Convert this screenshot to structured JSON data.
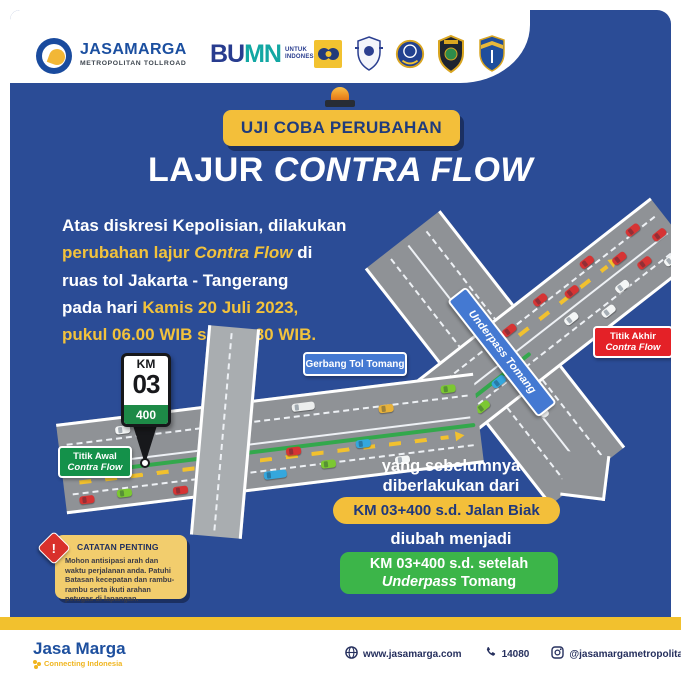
{
  "header": {
    "jasamarga_logo": {
      "title": "JASAMARGA",
      "subtitle": "METROPOLITAN TOLLROAD"
    },
    "bumn_logo": {
      "bu": "BU",
      "mn": "MN",
      "tagline_line1": "UNTUK",
      "tagline_line2": "INDONESIA"
    }
  },
  "banner": {
    "label": "UJI COBA PERUBAHAN"
  },
  "title": {
    "regular": "LAJUR ",
    "italic": "CONTRA FLOW"
  },
  "intro": {
    "line1": "Atas diskresi Kepolisian, dilakukan",
    "line2_highlight": "perubahan lajur ",
    "line2_italic": "Contra Flow",
    "line2_tail": " di",
    "line3": "ruas tol Jakarta - Tangerang",
    "line4_regular": "pada hari ",
    "line4_highlight": "Kamis 20 Juli 2023,",
    "line5_highlight": "pukul 06.00 WIB s.d. 08.30 WIB."
  },
  "map": {
    "km_sign": {
      "label": "KM",
      "number": "03",
      "meters": "400"
    },
    "start_badge": {
      "line1": "Titik Awal",
      "line2": "Contra Flow"
    },
    "toll_gate_badge": "Gerbang Tol Tomang",
    "underpass_badge": "Underpass Tomang",
    "end_badge": {
      "line1": "Titik Akhir",
      "line2": "Contra Flow"
    }
  },
  "change_info": {
    "before_line1": "yang sebelumnya",
    "before_line2": "diberlakukan dari",
    "before_value": "KM 03+400 s.d. Jalan Biak",
    "transition": "diubah menjadi",
    "after_line1": "KM 03+400 s.d. setelah",
    "after_italic": "Underpass",
    "after_tail": " Tomang"
  },
  "note": {
    "title": "CATATAN PENTING",
    "exclamation": "!",
    "body": "Mohon antisipasi arah dan waktu perjalanan anda. Patuhi Batasan kecepatan dan rambu-rambu serta ikuti arahan petugas di lapangan."
  },
  "footer": {
    "brand": "Jasa Marga",
    "tagline": "Connecting Indonesia",
    "website": "www.jasamarga.com",
    "phone": "14080",
    "instagram": "@jasamargametropolitan"
  },
  "colors": {
    "panel_blue": "#2B4C96",
    "accent_yellow": "#F3BF3A",
    "highlight_green": "#3CB549",
    "alert_red": "#E42127",
    "badge_blue": "#4479D2"
  }
}
